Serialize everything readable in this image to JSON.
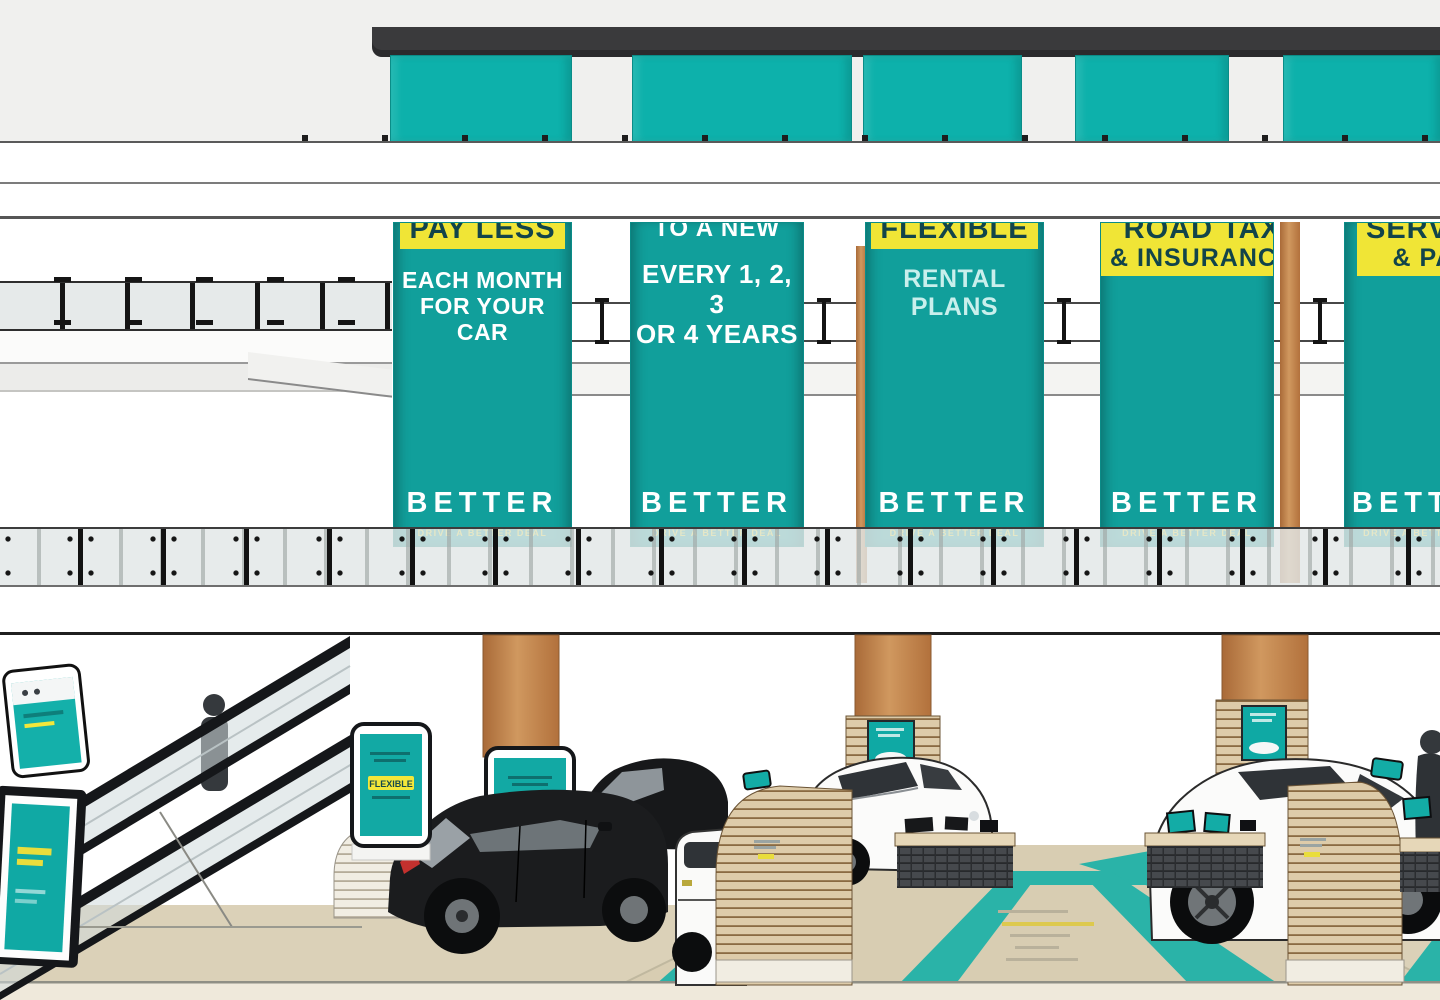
{
  "colors": {
    "banner_teal": "#119f9b",
    "facade_teal": "#0db1ab",
    "highlight_yellow": "#f0e536",
    "highlight_text": "#12444a",
    "roof_dark": "#3a3a3c",
    "column_tan": "#c0824c",
    "wood_slat": "#ddcba9",
    "desk_dark_front": "#46494d",
    "floor_beige": "#dbd1b8",
    "floor_teal": "#2ab3a8",
    "background_gray": "#f0f0ee"
  },
  "banners": [
    {
      "highlight": "PAY LESS",
      "line1": "EACH MONTH",
      "line2": "FOR YOUR CAR",
      "logo": "BETTER",
      "tagline": "DRIVE A BETTER DEAL"
    },
    {
      "top_line": "TO A NEW CAR",
      "line1": "EVERY 1, 2, 3",
      "line2": "OR 4 YEARS",
      "logo": "BETTER",
      "tagline": "DRIVE A BETTER DEAL"
    },
    {
      "highlight": "FLEXIBLE",
      "line1": "RENTAL PLANS",
      "logo": "BETTER",
      "tagline": "DRIVE A BETTER DEAL"
    },
    {
      "highlight": "ROAD TAX",
      "highlight2": "& INSURANCE",
      "logo": "BETTER",
      "tagline": "DRIVE A BETTER DEAL"
    },
    {
      "highlight": "SERVICING",
      "highlight2": "& PARTS",
      "logo": "BETTER",
      "tagline": "DRIVE A BETTER DEAL"
    }
  ],
  "showroom": {
    "kiosks": [
      {
        "label": "FLEXIBLE"
      },
      {
        "label": "BETTER"
      }
    ]
  }
}
